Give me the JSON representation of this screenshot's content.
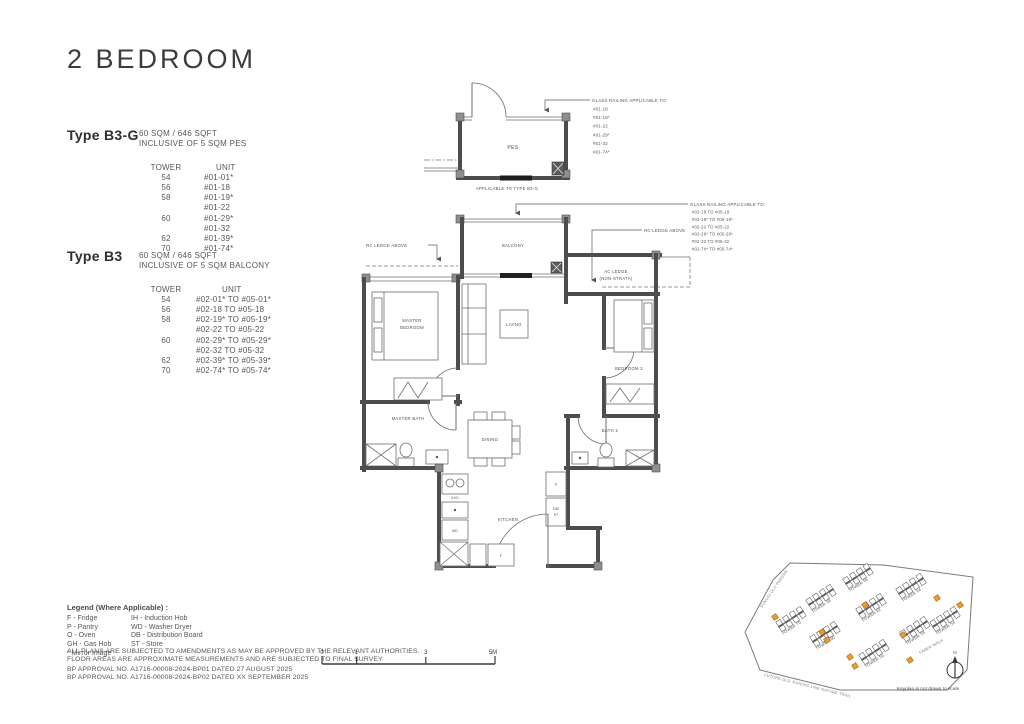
{
  "page": {
    "title": "2 BEDROOM"
  },
  "types": [
    {
      "name": "Type B3-G",
      "area": "60 SQM / 646 SQFT",
      "inclusive": "INCLUSIVE OF 5 SQM PES",
      "table": {
        "headers": [
          "TOWER",
          "UNIT"
        ],
        "rows": [
          [
            "54",
            "#01-01*"
          ],
          [
            "56",
            "#01-18"
          ],
          [
            "58",
            "#01-19*"
          ],
          [
            "",
            "#01-22"
          ],
          [
            "60",
            "#01-29*"
          ],
          [
            "",
            "#01-32"
          ],
          [
            "62",
            "#01-39*"
          ],
          [
            "70",
            "#01-74*"
          ]
        ]
      }
    },
    {
      "name": "Type B3",
      "area": "60 SQM / 646 SQFT",
      "inclusive": "INCLUSIVE OF 5 SQM BALCONY",
      "table": {
        "headers": [
          "TOWER",
          "UNIT"
        ],
        "rows": [
          [
            "54",
            "#02-01* TO #05-01*"
          ],
          [
            "56",
            "#02-18 TO #05-18"
          ],
          [
            "58",
            "#02-19* TO #05-19*"
          ],
          [
            "",
            "#02-22 TO #05-22"
          ],
          [
            "60",
            "#02-29* TO #05-29*"
          ],
          [
            "",
            "#02-32 TO #05-32"
          ],
          [
            "62",
            "#02-39* TO #05-39*"
          ],
          [
            "70",
            "#02-74* TO #05-74*"
          ]
        ]
      }
    }
  ],
  "floorplan": {
    "rooms": {
      "pes": "PES",
      "balcony": "BALCONY",
      "living": "LIVING",
      "master_bedroom_1": "MASTER",
      "master_bedroom_2": "BEDROOM",
      "bedroom2": "BEDROOM 2",
      "master_bath": "MASTER BATH",
      "bath2": "BATH 2",
      "dining": "DINING",
      "kitchen": "KITCHEN",
      "ac_ledge_1": "AC LEDGE",
      "ac_ledge_2": "(NON-STRATA)"
    },
    "fixtures": {
      "wd": "WD",
      "f": "F",
      "p": "P",
      "db_st_1": "DB/",
      "db_st_2": "ST",
      "hob": "IH/O"
    },
    "notes": {
      "applicable": "APPLICABLE TO TYPE B3-G",
      "rc_ledge_left": "RC LEDGE ABOVE",
      "rc_ledge_right": "RC LEDGE ABOVE"
    },
    "glass_railing_pes": {
      "title": "GLASS RAILING APPLICABLE TO:",
      "units": [
        "#01-18",
        "#01-19*",
        "#01-22",
        "#01-29*",
        "#01-32",
        "#01-74*"
      ]
    },
    "glass_railing_balcony": {
      "title": "GLASS RAILING APPLICABLE TO:",
      "units": [
        "#02-18 TO #05-18",
        "#02-19* TO #05-19*",
        "#02-22 TO #05-22",
        "#02-29* TO #05-29*",
        "#02-32 TO #05-32",
        "#02-74* TO #05-74*"
      ]
    }
  },
  "legend": {
    "title": "Legend (Where Applicable) :",
    "col1": [
      "F - Fridge",
      "P - Pantry",
      "O - Oven",
      "GH - Gas Hob",
      "* Mirror Image"
    ],
    "col2": [
      "IH - Induction Hob",
      "WD - Washer Dryer",
      "DB - Distribution Board",
      "ST - Store"
    ],
    "disclaimer": [
      "ALL PLANS ARE SUBJECTED TO AMENDMENTS AS MAY BE APPROVED BY THE RELEVANT AUTHORITIES.",
      "FLOOR AREAS ARE APPROXIMATE MEASUREMENTS AND ARE SUBJECTED TO FINAL SURVEY."
    ],
    "approvals": [
      "BP APPROVAL NO. A1716-00008-2024-BP01 DATED 27 AUGUST 2025",
      "BP APPROVAL NO. A1716-00008-2024-BP02 DATED XX SEPTEMBER 2025"
    ]
  },
  "scalebar": {
    "labels": [
      "0",
      "1",
      "3",
      "5M"
    ]
  },
  "keyplan": {
    "highlight_color": "#ee9a2d",
    "towers": [
      {
        "name": "TOWER 68",
        "x": 75,
        "y": 63
      },
      {
        "name": "TOWER 66",
        "x": 112,
        "y": 42
      },
      {
        "name": "TOWER 64",
        "x": 165,
        "y": 52
      },
      {
        "name": "TOWER 70",
        "x": 45,
        "y": 85
      },
      {
        "name": "TOWER 62",
        "x": 125,
        "y": 72
      },
      {
        "name": "TOWER 60",
        "x": 79,
        "y": 100
      },
      {
        "name": "TOWER 58",
        "x": 169,
        "y": 95
      },
      {
        "name": "TOWER 56",
        "x": 128,
        "y": 118
      },
      {
        "name": "TOWER 54",
        "x": 199,
        "y": 85
      }
    ],
    "highlights": [
      [
        37,
        67
      ],
      [
        127,
        55
      ],
      [
        84,
        82
      ],
      [
        89,
        90
      ],
      [
        165,
        85
      ],
      [
        172,
        110
      ],
      [
        112,
        107
      ],
      [
        117,
        116
      ],
      [
        199,
        48
      ],
      [
        222,
        55
      ]
    ],
    "streets": [
      {
        "label": "SUNGEI ULU PANDAN",
        "x": 24,
        "y": 58,
        "rot": -55
      },
      {
        "label": "FUTURE OLD JURONG LINE NATURE TRAIL",
        "x": 26,
        "y": 126,
        "rot": 14
      },
      {
        "label": "FABER WALK",
        "x": 182,
        "y": 104,
        "rot": -29
      }
    ],
    "north_label": "N",
    "note": "Keyplan is not drawn to scale"
  }
}
